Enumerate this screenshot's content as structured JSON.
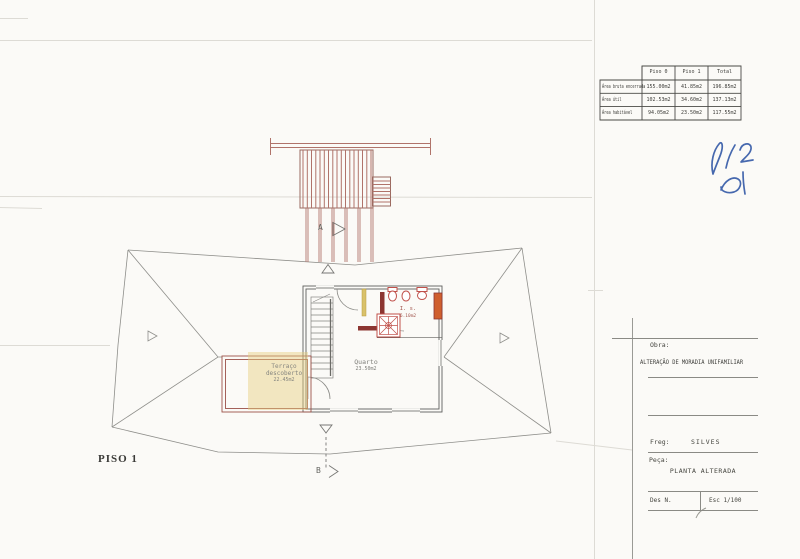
{
  "areas_table": {
    "columns": [
      "Piso 0",
      "Piso 1",
      "Total"
    ],
    "rows": [
      {
        "label": "Área bruta encerrada",
        "values": [
          "155.00m2",
          "41.85m2",
          "196.85m2"
        ]
      },
      {
        "label": "Área útil",
        "values": [
          "102.53m2",
          "34.60m2",
          "137.13m2"
        ]
      },
      {
        "label": "Área habitável",
        "values": [
          "94.05m2",
          "23.50m2",
          "117.55m2"
        ]
      }
    ]
  },
  "title_block": {
    "obra_label": "Obra:",
    "obra_value": "ALTERAÇÃO DE MORADIA UNIFAMILIAR",
    "freg_label": "Freg:",
    "freg_value": "SILVES",
    "peca_label": "Peça:",
    "peca_value": "PLANTA ALTERADA",
    "des_label": "Des N.",
    "esc_value": "Esc 1/100"
  },
  "plan": {
    "floor_label": "PISO 1",
    "section_marker_top": "A",
    "section_marker_bottom": "B",
    "rooms": {
      "quarto": {
        "name": "Quarto",
        "area": "23.50m2"
      },
      "instalacao_sanitaria": {
        "name": "I. s.",
        "area": "6.10m2"
      },
      "terraco": {
        "line1": "Terraço",
        "line2": "descoberto",
        "area": "22.45m2"
      }
    }
  },
  "colors": {
    "wall_red": "#8c3531",
    "pergola_red": "#b0736a",
    "highlight_yellow": "#e7cf7c",
    "fixture_red": "#c0504a",
    "column_orange": "#cf5f2e",
    "signature_blue": "#2e55a5"
  }
}
